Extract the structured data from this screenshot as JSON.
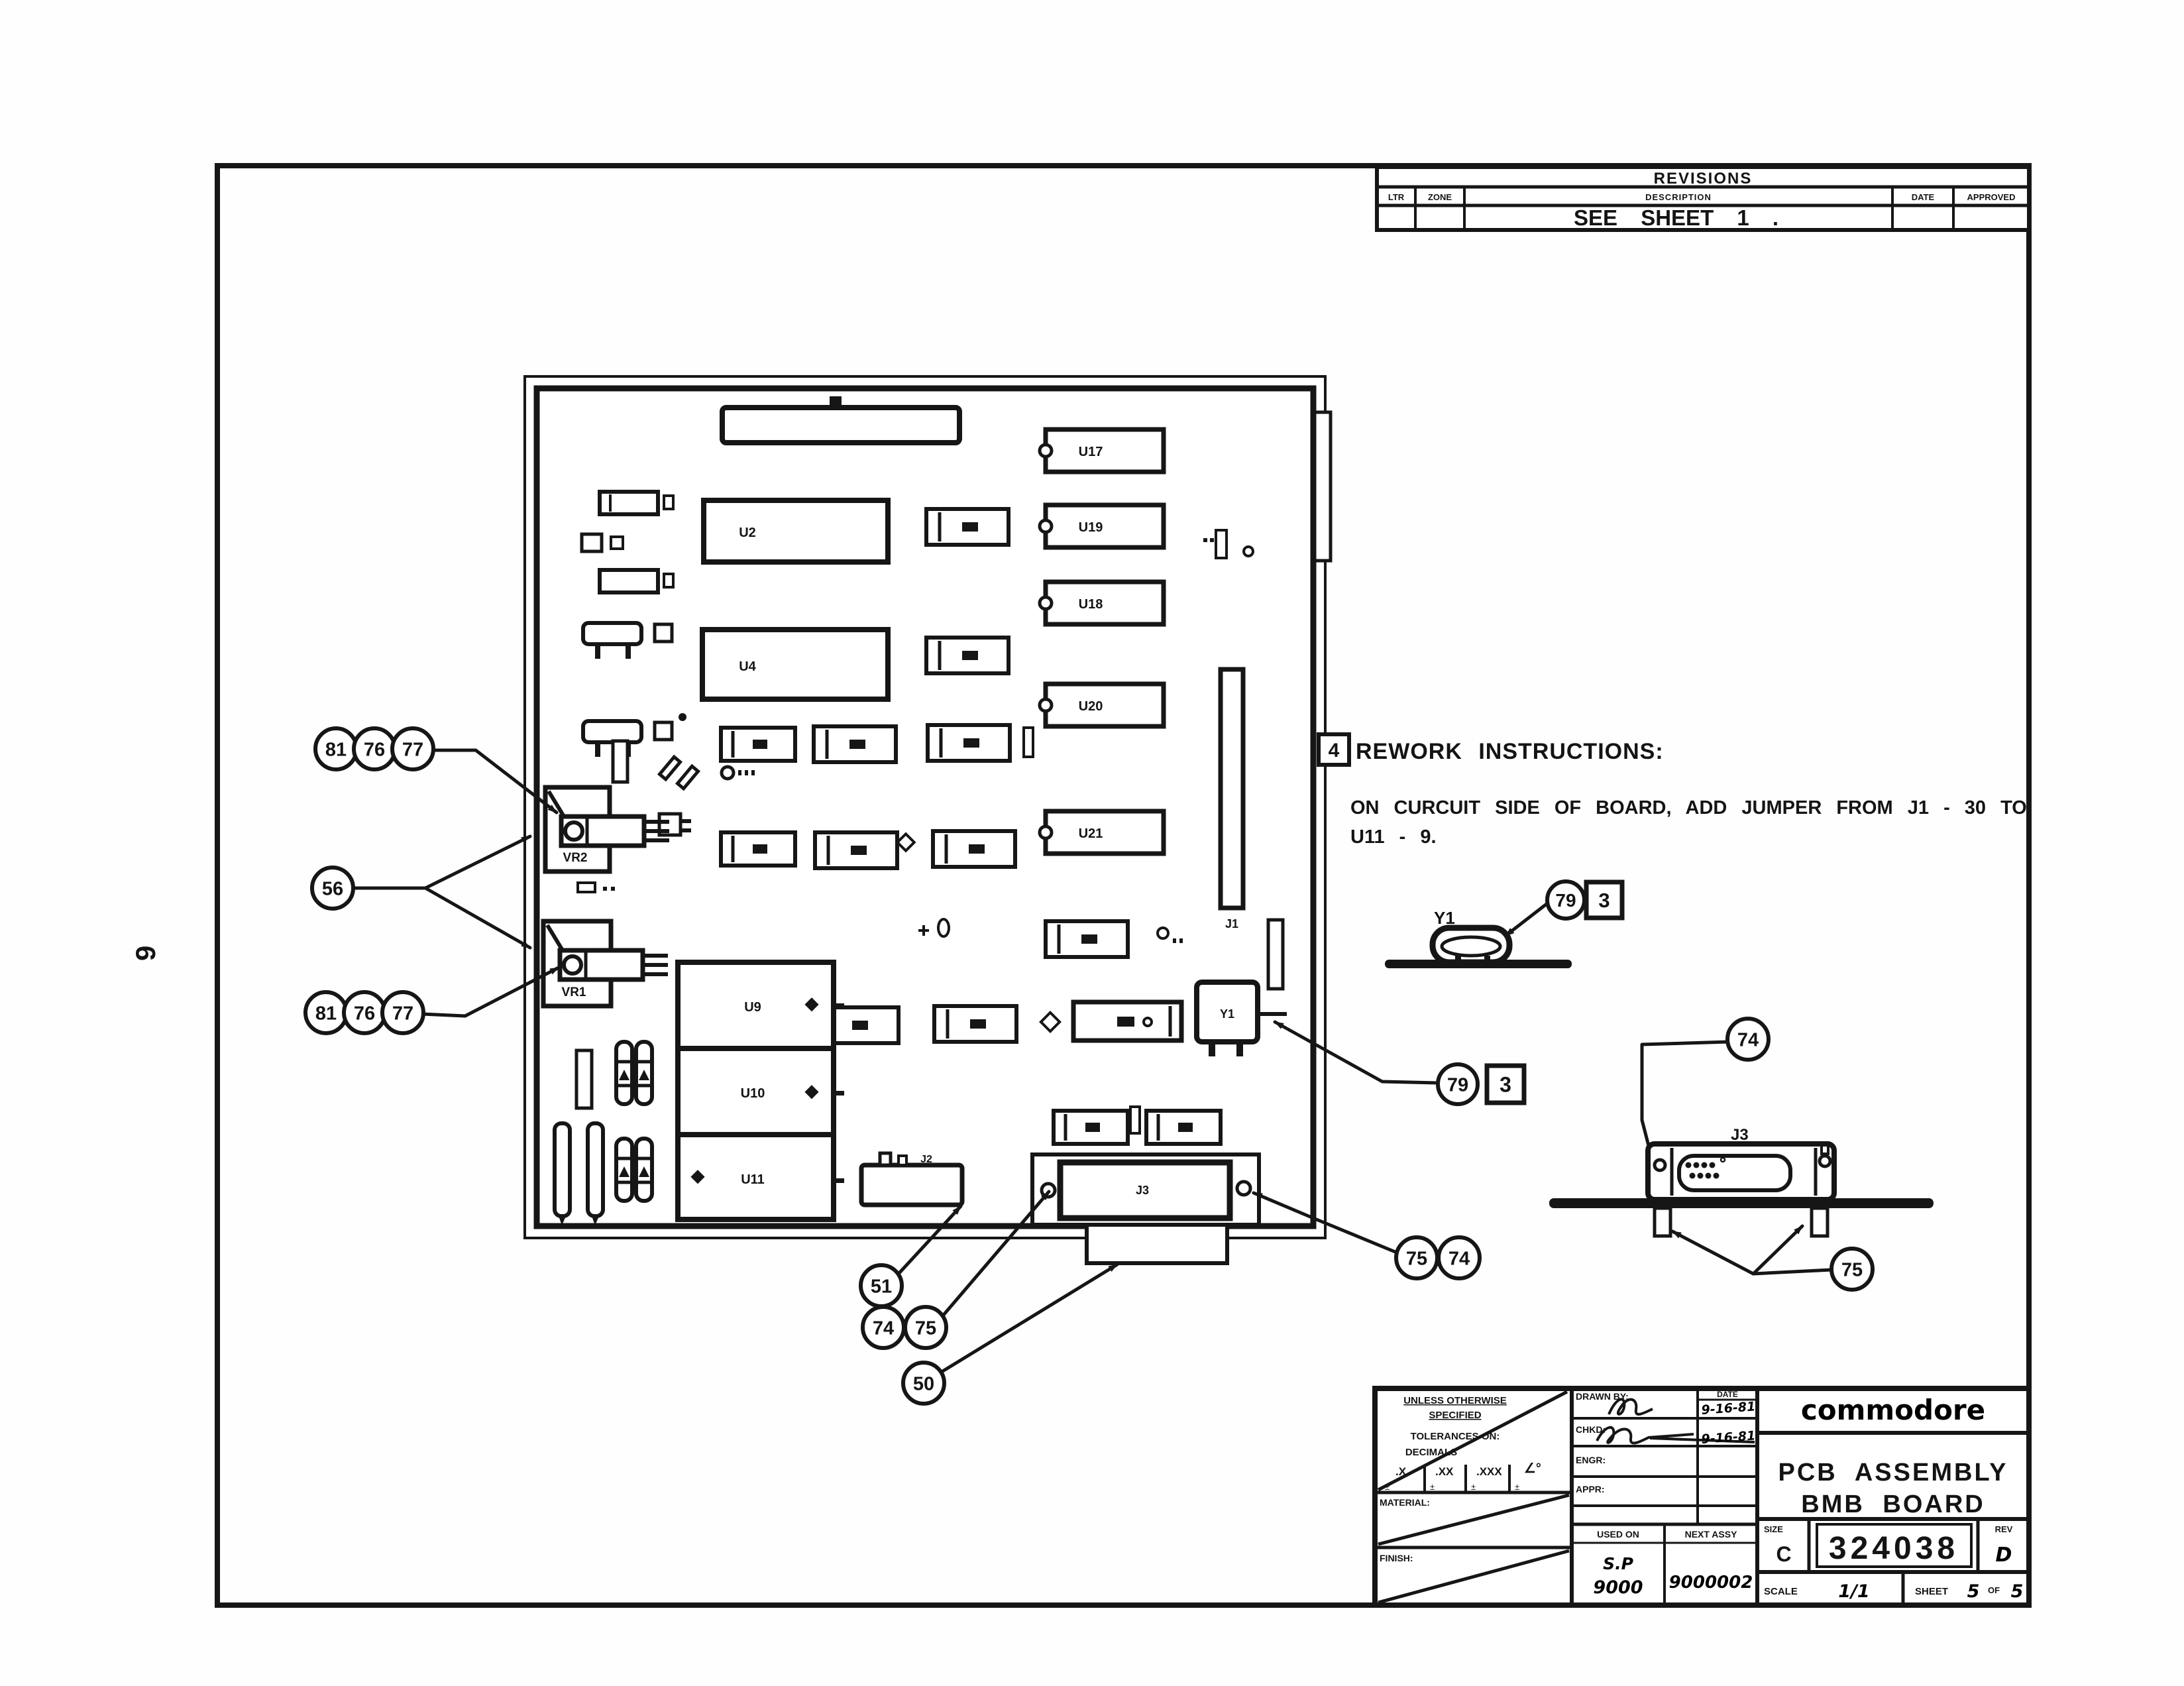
{
  "sheet": {
    "side_page_number": "9"
  },
  "revisions": {
    "title": "REVISIONS",
    "col_ltr": "LTR",
    "col_zone": "ZONE",
    "col_description": "DESCRIPTION",
    "col_date": "DATE",
    "col_approved": "APPROVED",
    "entry_description": "SEE  SHEET  1  ."
  },
  "rework": {
    "note_number": "4",
    "heading": "REWORK  INSTRUCTIONS:",
    "body_line1": "ON CURCUIT SIDE OF BOARD, ADD JUMPER FROM J1 - 30 TO",
    "body_line2": "U11 - 9."
  },
  "board": {
    "ref_u17": "U17",
    "ref_u19": "U19",
    "ref_u18": "U18",
    "ref_u20": "U20",
    "ref_u21": "U21",
    "ref_u2": "U2",
    "ref_u4": "U4",
    "ref_u9": "U9",
    "ref_u10": "U10",
    "ref_u11": "U11",
    "ref_vr1": "VR1",
    "ref_vr2": "VR2",
    "ref_j1": "J1",
    "ref_j2": "J2",
    "ref_j3": "J3",
    "ref_y1": "Y1"
  },
  "callouts": {
    "vr2_group": [
      "81",
      "76",
      "77"
    ],
    "both_regulators": "56",
    "vr1_group": [
      "81",
      "76",
      "77"
    ],
    "j2_ref": "51",
    "j3_left_pair": [
      "74",
      "75"
    ],
    "j3_shell": "50",
    "j3_right_pair": [
      "75",
      "74"
    ],
    "crystal_board": {
      "circle": "79",
      "box": "3"
    },
    "crystal_detail": {
      "circle": "79",
      "box": "3"
    },
    "detail_screw": "74",
    "detail_feet": "75"
  },
  "details": {
    "crystal_label": "Y1",
    "connector_label": "J3"
  },
  "title_block": {
    "spec_line1": "UNLESS OTHERWISE",
    "spec_line2": "SPECIFIED",
    "tolerances_label": "TOLERANCES ON:",
    "decimals_label": "DECIMALS",
    "tol_x": ".X",
    "tol_xx": ".XX",
    "tol_xxx": ".XXX",
    "tol_angle": "∠°",
    "tol_pm": "±",
    "material_label": "MATERIAL:",
    "finish_label": "FINISH:",
    "drawn_label": "DRAWN BY:",
    "date_label": "DATE",
    "drawn_date": "9-16-81",
    "chkd_label": "CHKD:",
    "chkd_date": "9-16-81",
    "engr_label": "ENGR:",
    "appr_label": "APPR:",
    "used_on_label": "USED ON",
    "used_on_line1": "S.P",
    "used_on_line2": "9000",
    "next_assy_label": "NEXT ASSY",
    "next_assy": "9000002",
    "brand": "commodore",
    "title_line1": "PCB  ASSEMBLY",
    "title_line2": "BMB  BOARD",
    "size_label": "SIZE",
    "size_value": "C",
    "drawing_number": "324038",
    "rev_label": "REV",
    "rev_value": "D",
    "scale_label": "SCALE",
    "scale_value": "1/1",
    "sheet_label": "SHEET",
    "sheet_number": "5",
    "of_label": "OF",
    "sheet_total": "5"
  }
}
